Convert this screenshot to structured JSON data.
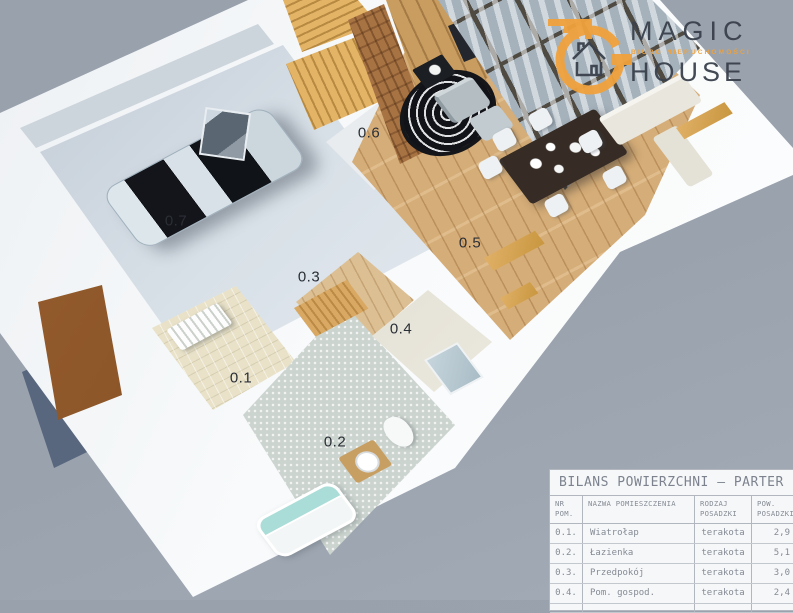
{
  "logo": {
    "brand_line1": "MAGIC",
    "brand_line2": "HOUSE",
    "tagline": "BIURO NIERUCHOMOŚCI",
    "accent_color": "#f0a23c",
    "text_color": "#3a414c"
  },
  "plan": {
    "room_labels": [
      {
        "text": "0.1"
      },
      {
        "text": "0.2"
      },
      {
        "text": "0.3"
      },
      {
        "text": "0.4"
      },
      {
        "text": "0.5"
      },
      {
        "text": "0.6"
      },
      {
        "text": "0.7"
      }
    ]
  },
  "area_table": {
    "title": "BILANS POWIERZCHNI – PARTER",
    "columns": [
      {
        "line1": "NR",
        "line2": "POM."
      },
      {
        "line1": "NAZWA POMIESZCZENIA",
        "line2": ""
      },
      {
        "line1": "RODZAJ",
        "line2": "POSADZKI"
      },
      {
        "line1": "POW.",
        "line2": "POSADZKI"
      }
    ],
    "rows": [
      {
        "nr": "0.1.",
        "name": "Wiatrołap",
        "floor_type": "terakota",
        "area": "2,9"
      },
      {
        "nr": "0.2.",
        "name": "Łazienka",
        "floor_type": "terakota",
        "area": "5,1"
      },
      {
        "nr": "0.3.",
        "name": "Przedpokój",
        "floor_type": "terakota",
        "area": "3,0"
      },
      {
        "nr": "0.4.",
        "name": "Pom. gospod.",
        "floor_type": "terakota",
        "area": "2,4"
      }
    ]
  }
}
